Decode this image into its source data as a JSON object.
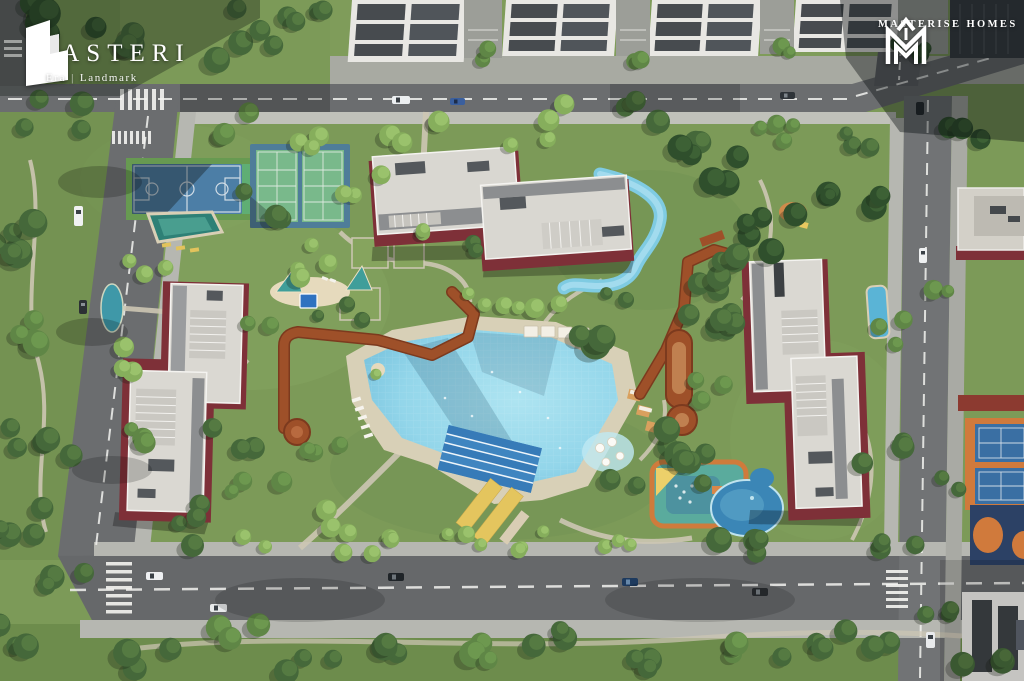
{
  "branding": {
    "masteri": {
      "title_initial": "M",
      "title_rest": "ASTERI",
      "subtitle_left": "Era",
      "subtitle_divider": "|",
      "subtitle_right": "Landmark"
    },
    "masterise": {
      "name": "MASTERISE HOMES"
    }
  },
  "scene": {
    "type": "aerial-3d-masterplan-render",
    "features": [
      "townhouse-rows",
      "basketball-court",
      "tennis-courts",
      "leisure-pool",
      "lap-lanes",
      "lazy-river",
      "kids-playground",
      "splash-pond",
      "rust-boardwalk",
      "apartment-buildings",
      "perimeter-roads",
      "tree-lined-park"
    ]
  },
  "palette": {
    "lawn": "#7c9a58",
    "asphalt": "#6b6d6f",
    "sidewalk": "#b5b6b0",
    "deck": "#dbd2ba",
    "pool": "#9fdcec",
    "lap_pool": "#3f85c0",
    "river": "#7fcbe2",
    "boardwalk": "#9e5029",
    "building_roof": "#d9d7d1",
    "building_base": "#7e3038",
    "townhouse_roof": "#474b4f",
    "court_green": "#79b98b",
    "court_blue": "#4c7ea6",
    "court_navy": "#2c4165",
    "playground_teal": "#5aab9d",
    "playground_orange": "#cf7b3c",
    "logo_text": "#ffffff"
  }
}
